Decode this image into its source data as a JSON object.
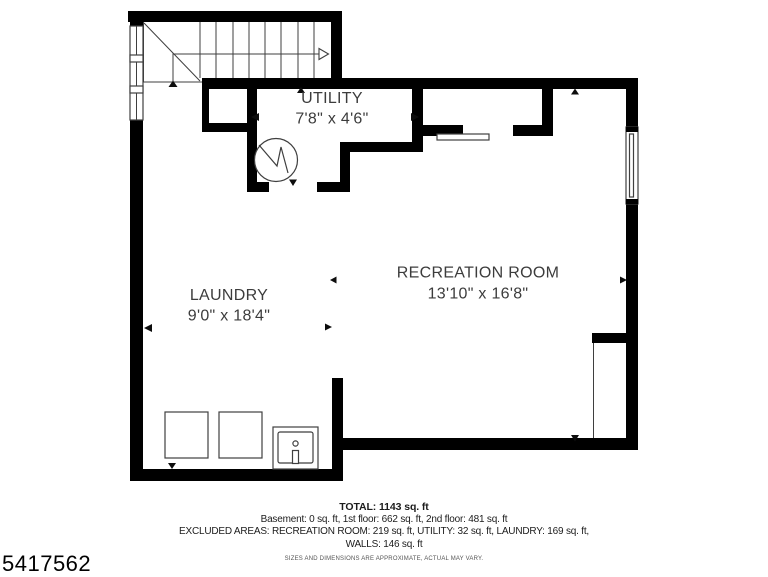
{
  "plan": {
    "id": "5417562",
    "rooms": {
      "utility": {
        "name": "UTILITY",
        "dims": "7'8\" x 4'6\""
      },
      "laundry": {
        "name": "LAUNDRY",
        "dims": "9'0\" x 18'4\""
      },
      "recreation": {
        "name": "RECREATION ROOM",
        "dims": "13'10\" x 16'8\""
      }
    },
    "colors": {
      "wall": "#000000",
      "line": "#3f3f3f",
      "label": "#3c3c3c",
      "background": "#ffffff"
    }
  },
  "footer": {
    "total": "TOTAL: 1143 sq. ft",
    "floors": "Basement: 0 sq. ft, 1st floor: 662 sq. ft, 2nd floor: 481 sq. ft",
    "excluded_areas": "EXCLUDED AREAS: RECREATION ROOM: 219 sq. ft, UTILITY: 32 sq. ft, LAUNDRY: 169 sq. ft,",
    "walls": "WALLS: 146 sq. ft",
    "disclaimer": "SIZES AND DIMENSIONS ARE APPROXIMATE, ACTUAL MAY VARY."
  }
}
